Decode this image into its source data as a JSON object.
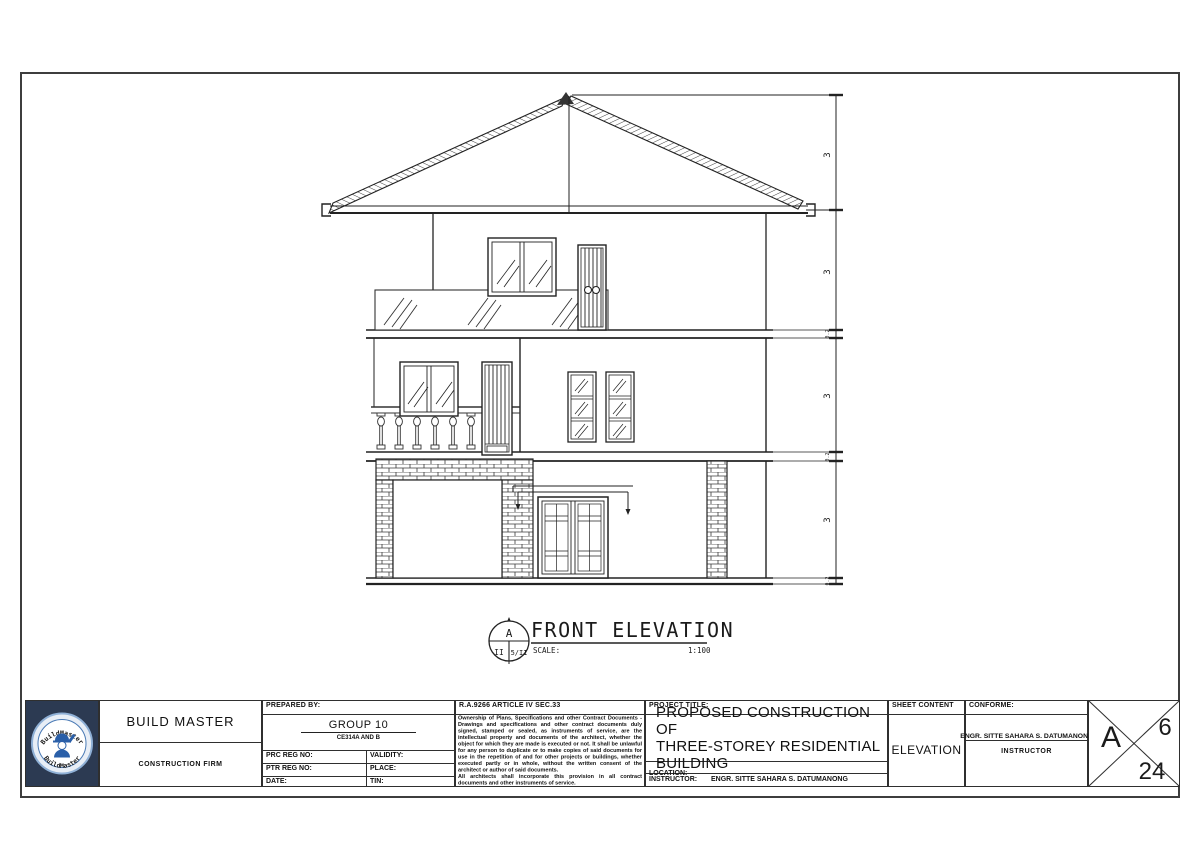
{
  "drawing": {
    "marker_top": "A",
    "marker_bottom_left": "II",
    "marker_bottom_right": "5/II",
    "title": "FRONT ELEVATION",
    "scale_label": "SCALE:",
    "scale_value": "1:100"
  },
  "dims": {
    "floor_heights": [
      "3",
      "3",
      "3",
      "3"
    ],
    "slab_gaps": [
      "0.2",
      "0.2",
      "0.2"
    ]
  },
  "titleblock": {
    "logo_arc_top": "BuildMaster",
    "logo_arc_bottom": "BuildMaster",
    "firm_name": "BUILD MASTER",
    "firm_subtitle": "CONSTRUCTION FIRM",
    "prepared_by_label": "PREPARED BY:",
    "group_name": "GROUP 10",
    "group_section": "CE314A AND B",
    "prc_label": "PRC REG NO:",
    "validity_label": "VALIDITY:",
    "ptr_label": "PTR REG NO:",
    "place_label": "PLACE:",
    "date_label": "DATE:",
    "tin_label": "TIN:",
    "ra_header": "R.A.9266 ARTICLE IV SEC.33",
    "ra_body_1": "Ownership of Plans, Specifications and other Contract Documents - Drawings and specifications and other contract documents duly signed, stamped or sealed, as instruments of service, are the intellectual property and documents of the architect, whether the object for which they are made is executed or not. It shall be unlawful for any person to duplicate or to make copies of said documents for use in the repetition of and for other projects or buildings, whether executed partly or in whole, without the written consent of the architect or author of said documents.",
    "ra_body_2": "All architects shall incorporate this provision in all contract documents and other instruments of service.",
    "project_title_label": "PROJECT TITLE:",
    "project_title_line1": "PROPOSED CONSTRUCTION OF",
    "project_title_line2": "THREE-STOREY RESIDENTIAL BUILDING",
    "location_label": "LOCATION:",
    "instructor_label": "INSTRUCTOR:",
    "instructor_name": "ENGR. SITTE SAHARA S. DATUMANONG",
    "sheet_content_label": "SHEET CONTENT",
    "sheet_content_value": "ELEVATION",
    "conforme_label": "CONFORME:",
    "conforme_name": "ENGR. SITTE SAHARA S. DATUMANONG",
    "conforme_title": "INSTRUCTOR",
    "sheet_series": "A",
    "sheet_number": "6",
    "sheet_total": "24"
  },
  "colors": {
    "logo_bg": "#2c3a52",
    "logo_blue": "#2a5fa8",
    "line": "#2f2f2f"
  }
}
